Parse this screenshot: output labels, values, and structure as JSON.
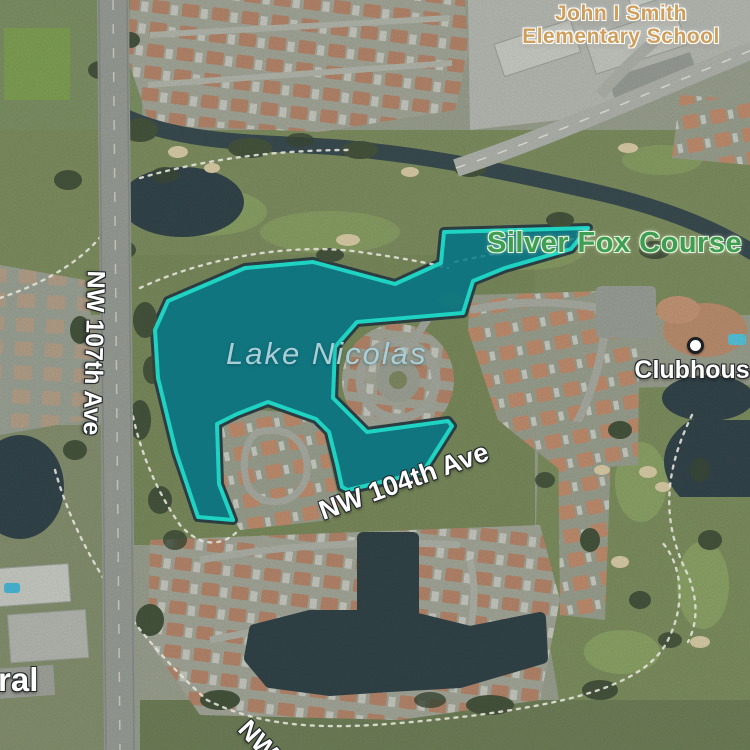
{
  "map": {
    "labels": {
      "school_line1": "John I Smith",
      "school_line2": "Elementary School",
      "golf_course": "Silver Fox Course",
      "lake": "Lake Nicolas",
      "clubhouse": "Clubhouse",
      "street_left": "NW 107th Ave",
      "street_center": "NW 104th Ave",
      "street_bottom_partial": "NW",
      "left_edge_partial": "ral"
    },
    "highlight": {
      "name": "Lake Nicolas",
      "polygon_points": "168,301 245,268 313,262 395,284 441,263 444,232 588,228 571,249 505,268 473,281 463,313 357,322 335,347 333,398 367,432 448,421 452,426 423,472 348,490 342,487 337,464 329,432 316,419 268,402 237,414 217,424 219,484 233,520 198,517 176,452 158,378 155,330",
      "stroke_color": "#1fd3c2",
      "fill_color": "#0d7d88"
    },
    "colors": {
      "school_label": "#cf9e5c",
      "course_label": "#3f9e53",
      "lake_label": "#a9ced6",
      "street_label": "#ffffff"
    }
  }
}
